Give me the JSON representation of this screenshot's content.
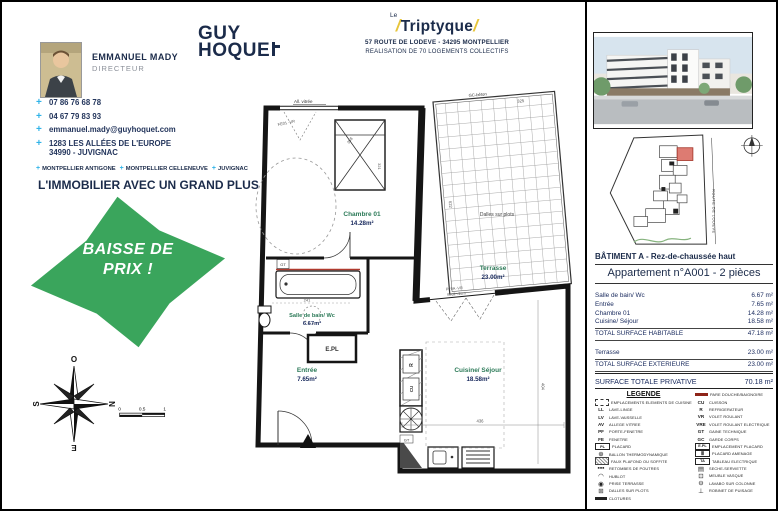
{
  "agent": {
    "name": "EMMANUEL MADY",
    "role": "DIRECTEUR",
    "contacts": [
      {
        "icon": "plus-phone-icon",
        "glyph": "+",
        "text": "07 86 76 68 78",
        "text2": ""
      },
      {
        "icon": "plus-phone-icon",
        "glyph": "+",
        "text": "04 67 79 83 93",
        "text2": ""
      },
      {
        "icon": "plus-mail-icon",
        "glyph": "+",
        "text": "emmanuel.mady@guyhoquet.com",
        "text2": ""
      },
      {
        "icon": "plus-address-icon",
        "glyph": "+",
        "text": "1283 LES ALLÉES DE L'EUROPE",
        "text2": "34990 - JUVIGNAC"
      }
    ],
    "agencies": [
      "MONTPELLIER ANTIGONE",
      "MONTPELLIER CELLENEUVE",
      "JUVIGNAC"
    ],
    "slogan": "L'IMMOBILIER AVEC UN GRAND PLUS"
  },
  "badge": {
    "line1": "BAISSE DE",
    "line2": "PRIX !",
    "color": "#3aa55c"
  },
  "brand": {
    "word1": "GUY",
    "word2": "HOQUE"
  },
  "project": {
    "le": "Le",
    "name": "Triptyque",
    "address": "57 ROUTE DE LODEVE  - 34295 MONTPELLIER",
    "subtitle": "REALISATION DE 70 LOGEMENTS COLLECTIFS"
  },
  "plan": {
    "rooms": {
      "chambre": {
        "name": "Chambre 01",
        "area": "14.28m²"
      },
      "bain": {
        "name": "Salle de bain/ Wc",
        "area": "6.67m²"
      },
      "entree": {
        "name": "Entrée",
        "area": "7.65m²"
      },
      "cuisine": {
        "name": "Cuisine/ Séjour",
        "area": "18.58m²"
      },
      "terrasse": {
        "name": "Terrasse",
        "area": "23.00m²"
      }
    },
    "labels": {
      "allege": "All. vitrée",
      "fe": "FE01 -VR",
      "gc_beton": "GC-béton",
      "dalles": "Dalles sur plots",
      "pf": "PF0A -VR",
      "seuil": "Seuil <2cm",
      "epl": "E.PL",
      "gt_bath": "GT",
      "gt_kitchen": "GT",
      "fridge": "R",
      "cuisson": "CU"
    },
    "dims": {
      "d358": "358",
      "d321": "321",
      "d241": "241",
      "d325": "325",
      "d622": "622",
      "d404": "404",
      "d436": "436"
    }
  },
  "sidebar": {
    "building_title": "BÂTIMENT A  - Rez-de-chaussée haut",
    "apartment_title": "Appartement n°A001  - 2 pièces",
    "surface_rows": [
      {
        "label": "Salle de bain/ Wc",
        "value": "6.67 m²"
      },
      {
        "label": "Entrée",
        "value": "7.65 m²"
      },
      {
        "label": "Chambre 01",
        "value": "14.28 m²"
      },
      {
        "label": "Cuisine/ Séjour",
        "value": "18.58 m²"
      }
    ],
    "total_habitable": {
      "label": "TOTAL SURFACE HABITABLE",
      "value": "47.18 m²"
    },
    "exterior_rows": [
      {
        "label": "Terrasse",
        "value": "23.00 m²"
      }
    ],
    "total_exterieure": {
      "label": "TOTAL SURFACE EXTERIEURE",
      "value": "23.00 m²"
    },
    "total_privative": {
      "label": "SURFACE TOTALE PRIVATIVE",
      "value": "70.18 m²"
    },
    "site_road": "ROUTE DE LODEVE",
    "legend": {
      "title": "LEGENDE",
      "left": [
        {
          "icon": "kitchen-elements-icon",
          "style": "dashedbox",
          "glyph": "",
          "label": "EMPLACEMENTS ELEMENTS DE CUISINE"
        },
        {
          "icon": "washing-machine-icon",
          "style": "letters",
          "glyph": "LL",
          "label": "LAVE-LINGE"
        },
        {
          "icon": "dishwasher-icon",
          "style": "letters",
          "glyph": "LV",
          "label": "LAVE-VAISSELLE"
        },
        {
          "icon": "glazed-sill-icon",
          "style": "letters",
          "glyph": "AV",
          "label": "ALLEGE VITREE"
        },
        {
          "icon": "french-window-icon",
          "style": "letters",
          "glyph": "PF",
          "label": "PORTE-FENETRE"
        },
        {
          "icon": "window-icon",
          "style": "letters",
          "glyph": "FE",
          "label": "FENETRE"
        },
        {
          "icon": "closet-icon",
          "style": "box",
          "glyph": "PL",
          "label": "PLACARD"
        },
        {
          "icon": "heat-pump-boiler-icon",
          "style": "glyph",
          "glyph": "⊕",
          "label": "BALLON THERMODYNAMIQUE"
        },
        {
          "icon": "false-ceiling-icon",
          "style": "hatch",
          "glyph": "",
          "label": "FAUX PLAFOND OU SOFFITE"
        },
        {
          "icon": "beam-drop-icon",
          "style": "glyph",
          "glyph": "▪▪▪",
          "label": "RETOMBES DE POUTRES"
        },
        {
          "icon": "porthole-icon",
          "style": "glyph",
          "glyph": "◠",
          "label": "HUBLOT"
        },
        {
          "icon": "terrace-socket-icon",
          "style": "glyph",
          "glyph": "◉",
          "label": "PRISE TERRASSE"
        },
        {
          "icon": "slabs-icon",
          "style": "glyph",
          "glyph": "⊞",
          "label": "DALLES SUR PLOTS"
        },
        {
          "icon": "fence-icon",
          "style": "darkbar",
          "glyph": "",
          "label": "CLOTURES"
        }
      ],
      "right": [
        {
          "icon": "shower-screen-icon",
          "style": "redbar",
          "glyph": "",
          "label": "PARE DOUCHE/BAIGNOIRE"
        },
        {
          "icon": "cooktop-icon",
          "style": "letters",
          "glyph": "CU",
          "label": "CUISSON"
        },
        {
          "icon": "fridge-icon",
          "style": "letters",
          "glyph": "R",
          "label": "REFRIGERATEUR"
        },
        {
          "icon": "roller-shutter-icon",
          "style": "letters",
          "glyph": "VR",
          "label": "VOLET ROULANT"
        },
        {
          "icon": "electric-shutter-icon",
          "style": "letters",
          "glyph": "VRE",
          "label": "VOLET ROULANT ELECTRIQUE"
        },
        {
          "icon": "technical-duct-icon",
          "style": "letters",
          "glyph": "GT",
          "label": "GAINE TECHNIQUE"
        },
        {
          "icon": "guardrail-icon",
          "style": "letters",
          "glyph": "GC",
          "label": "GARDE CORPS"
        },
        {
          "icon": "closet-space-icon",
          "style": "box",
          "glyph": "E.PL",
          "label": "EMPLACEMENT PLACARD"
        },
        {
          "icon": "fitted-closet-icon",
          "style": "box",
          "glyph": "≣",
          "label": "PLACARD AMENAGE"
        },
        {
          "icon": "electrical-panel-icon",
          "style": "box",
          "glyph": "TA",
          "label": "TABLEAU ELECTRIQUE"
        },
        {
          "icon": "towel-dryer-icon",
          "style": "glyph",
          "glyph": "▤",
          "label": "SECHE-SERVIETTE"
        },
        {
          "icon": "vanity-unit-icon",
          "style": "glyph",
          "glyph": "⊡",
          "label": "MEUBLE VASQUE"
        },
        {
          "icon": "pedestal-sink-icon",
          "style": "glyph",
          "glyph": "⊖",
          "label": "LAVABO SUR COLONNE"
        },
        {
          "icon": "outdoor-tap-icon",
          "style": "glyph",
          "glyph": "⊥",
          "label": "ROBINET DE PUISAGE"
        }
      ]
    }
  },
  "compass": {
    "top": "O",
    "right": "N",
    "bottom": "E",
    "left": "S"
  },
  "scale": {
    "t0": "0",
    "t1": "0.5",
    "t2": "1"
  }
}
